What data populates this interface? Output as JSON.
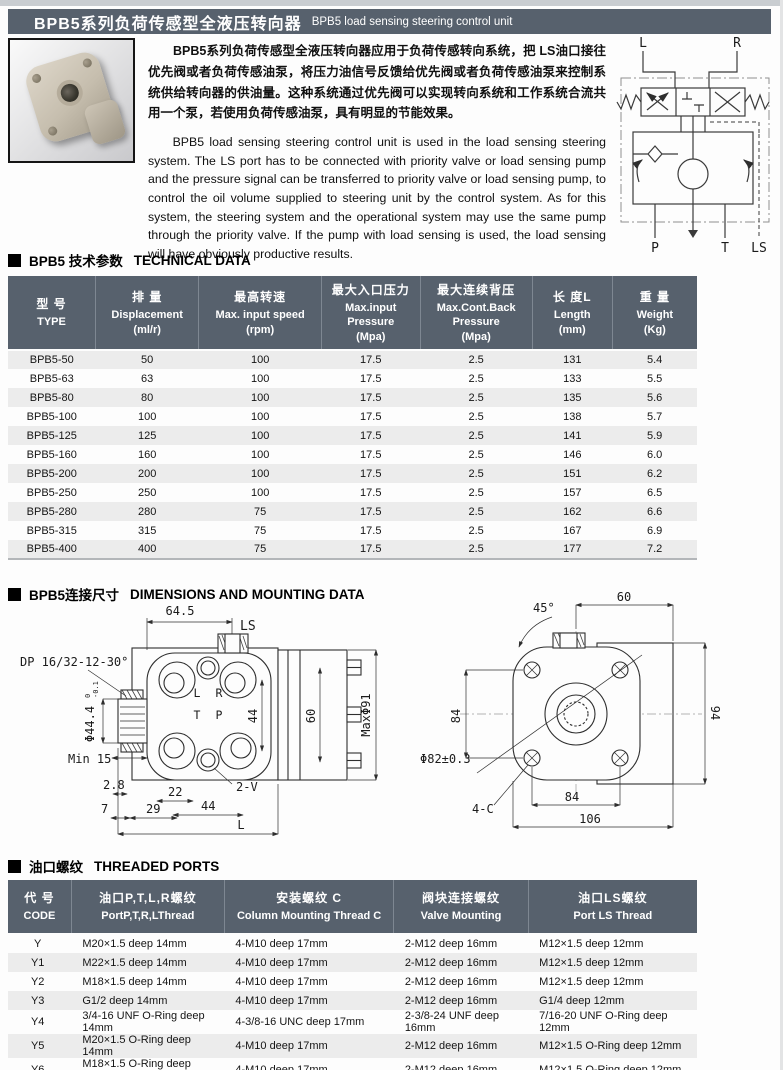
{
  "header": {
    "title_zh": "BPB5系列负荷传感型全液压转向器",
    "title_en": "BPB5 load sensing steering control unit"
  },
  "intro": {
    "paragraph_zh": "BPB5系列负荷传感型全液压转向器应用于负荷传感转向系统，把 LS油口接往优先阀或者负荷传感油泵，将压力油信号反馈给优先阀或者负荷传感油泵来控制系统供给转向器的供油量。这种系统通过优先阀可以实现转向系统和工作系统合流共用一个泵，若使用负荷传感油泵，具有明显的节能效果。",
    "paragraph_en": "BPB5 load sensing steering control unit is used in the load sensing steering system. The LS port has to be connected with priority valve or load sensing pump and the pressure signal can be transferred to priority valve or load sensing pump, to control the oil volume supplied to steering unit by the control system. As for this system, the steering system and the operational system may use the same pump through the priority valve. If the pump with load sensing is used, the load sensing will have obviously productive results."
  },
  "diagram": {
    "labels": {
      "l": "L",
      "r": "R",
      "p": "P",
      "t": "T",
      "ls": "LS"
    }
  },
  "sections": {
    "technical": {
      "title_zh": "BPB5 技术参数",
      "title_en": "TECHNICAL DATA"
    },
    "dimensions": {
      "title_zh": "BPB5连接尺寸",
      "title_en": "DIMENSIONS AND MOUNTING DATA"
    },
    "ports": {
      "title_zh": "油口螺纹",
      "title_en": "THREADED PORTS"
    }
  },
  "technical_table": {
    "columns": [
      [
        "型 号",
        "TYPE"
      ],
      [
        "排 量",
        "Displacement",
        "(ml/r)"
      ],
      [
        "最高转速",
        "Max. input speed",
        "(rpm)"
      ],
      [
        "最大入口压力",
        "Max.input",
        "Pressure",
        "(Mpa)"
      ],
      [
        "最大连续背压",
        "Max.Cont.Back",
        "Pressure",
        "(Mpa)"
      ],
      [
        "长 度L",
        "Length",
        "(mm)"
      ],
      [
        "重 量",
        "Weight",
        "(Kg)"
      ]
    ],
    "rows": [
      [
        "BPB5-50",
        "50",
        "100",
        "17.5",
        "2.5",
        "131",
        "5.4"
      ],
      [
        "BPB5-63",
        "63",
        "100",
        "17.5",
        "2.5",
        "133",
        "5.5"
      ],
      [
        "BPB5-80",
        "80",
        "100",
        "17.5",
        "2.5",
        "135",
        "5.6"
      ],
      [
        "BPB5-100",
        "100",
        "100",
        "17.5",
        "2.5",
        "138",
        "5.7"
      ],
      [
        "BPB5-125",
        "125",
        "100",
        "17.5",
        "2.5",
        "141",
        "5.9"
      ],
      [
        "BPB5-160",
        "160",
        "100",
        "17.5",
        "2.5",
        "146",
        "6.0"
      ],
      [
        "BPB5-200",
        "200",
        "100",
        "17.5",
        "2.5",
        "151",
        "6.2"
      ],
      [
        "BPB5-250",
        "250",
        "100",
        "17.5",
        "2.5",
        "157",
        "6.5"
      ],
      [
        "BPB5-280",
        "280",
        "75",
        "17.5",
        "2.5",
        "162",
        "6.6"
      ],
      [
        "BPB5-315",
        "315",
        "75",
        "17.5",
        "2.5",
        "167",
        "6.9"
      ],
      [
        "BPB5-400",
        "400",
        "75",
        "17.5",
        "2.5",
        "177",
        "7.2"
      ]
    ]
  },
  "ports_table": {
    "columns": [
      [
        "代 号",
        "CODE"
      ],
      [
        "油口P,T,L,R螺纹",
        "PortP,T,R,LThread"
      ],
      [
        "安装螺纹 C",
        "Column Mounting Thread C"
      ],
      [
        "阀块连接螺纹",
        "Valve Mounting"
      ],
      [
        "油口LS螺纹",
        "Port LS Thread"
      ]
    ],
    "rows": [
      [
        "Y",
        "M20×1.5 deep 14mm",
        "4-M10 deep 17mm",
        "2-M12 deep 16mm",
        "M12×1.5 deep 12mm"
      ],
      [
        "Y1",
        "M22×1.5 deep 14mm",
        "4-M10 deep 17mm",
        "2-M12 deep 16mm",
        "M12×1.5 deep 12mm"
      ],
      [
        "Y2",
        "M18×1.5 deep 14mm",
        "4-M10 deep 17mm",
        "2-M12 deep 16mm",
        "M12×1.5 deep 12mm"
      ],
      [
        "Y3",
        "G1/2 deep 14mm",
        "4-M10 deep 17mm",
        "2-M12 deep 16mm",
        "G1/4 deep 12mm"
      ],
      [
        "Y4",
        "3/4-16 UNF O-Ring deep 14mm",
        "4-3/8-16 UNC deep 17mm",
        "2-3/8-24 UNF deep 16mm",
        "7/16-20 UNF O-Ring deep 12mm"
      ],
      [
        "Y5",
        "M20×1.5 O-Ring deep 14mm",
        "4-M10 deep 17mm",
        "2-M12 deep 16mm",
        "M12×1.5 O-Ring deep 12mm"
      ],
      [
        "Y6",
        "M18×1.5 O-Ring deep 14mm",
        "4-M10 deep 17mm",
        "2-M12 deep 16mm",
        "M12×1.5 O-Ring deep 12mm"
      ]
    ]
  },
  "drawing_left": {
    "labels": {
      "dim_64_5": "64.5",
      "ls": "LS",
      "spline": "DP 16/32-12-30°",
      "dia_shaft": "Φ44.4",
      "tol_upper": "0",
      "tol_lower": "-0.1",
      "min_15": "Min 15",
      "dim_2_8": "2.8",
      "dim_7": "7",
      "dim_29": "29",
      "dim_22": "22",
      "dim_44_bottom": "44",
      "dim_2v": "2-V",
      "dim_l": "L",
      "face_l": "L",
      "face_r": "R",
      "face_t": "T",
      "face_p": "P",
      "dim_44_right": "44",
      "dim_60": "60",
      "max_dia": "MaxΦ91"
    }
  },
  "drawing_right": {
    "labels": {
      "angle_45": "45°",
      "dim_60": "60",
      "dim_84_left": "84",
      "dia_82": "Φ82±0.3",
      "four_c": "4-C",
      "dim_84_bottom": "84",
      "dim_106": "106",
      "dim_94": "94"
    }
  },
  "colors": {
    "title_bar": "#57616d",
    "table_header": "#57616d",
    "row_alternate": "#ececec",
    "top_strip": "#c9cdd1",
    "text": "#141414"
  }
}
